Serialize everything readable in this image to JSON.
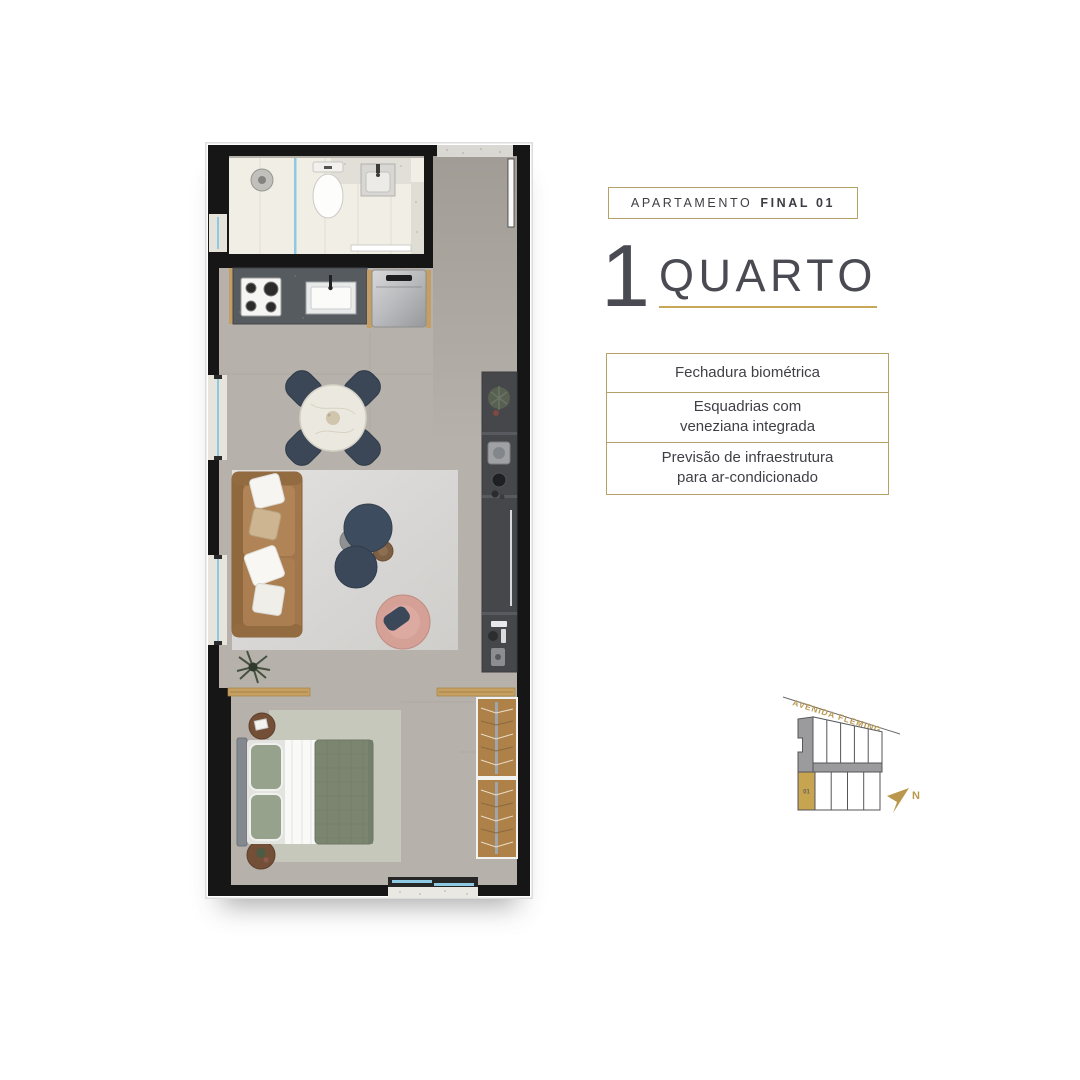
{
  "header": {
    "badge": {
      "prefix": "APARTAMENTO",
      "bold": "FINAL 01"
    },
    "title": {
      "number": "1",
      "word": "QUARTO"
    }
  },
  "features": [
    {
      "text": "Fechadura biométrica"
    },
    {
      "text": "Esquadrias com\nveneziana integrada"
    },
    {
      "text": "Previsão de infraestrutura\npara ar-condicionado"
    }
  ],
  "sitemap": {
    "street": "AVENIDA FLEMING",
    "unit": "01",
    "north": "N"
  },
  "colors": {
    "gold_border": "#b5a269",
    "gold_underline": "#c9a758",
    "gold_unit": "#c7a44f",
    "gold_street": "#b9984e",
    "text_dark": "#3f3f46",
    "wall_black": "#161616",
    "floor_greige": "#b6b2ab",
    "bath_marble": "#f1eee5",
    "glass_blue": "#8ec9e3",
    "sofa_caramel": "#a1764a",
    "chair_navy": "#3b4756",
    "bed_sage": "#7b8570",
    "wood": "#c59f63"
  }
}
